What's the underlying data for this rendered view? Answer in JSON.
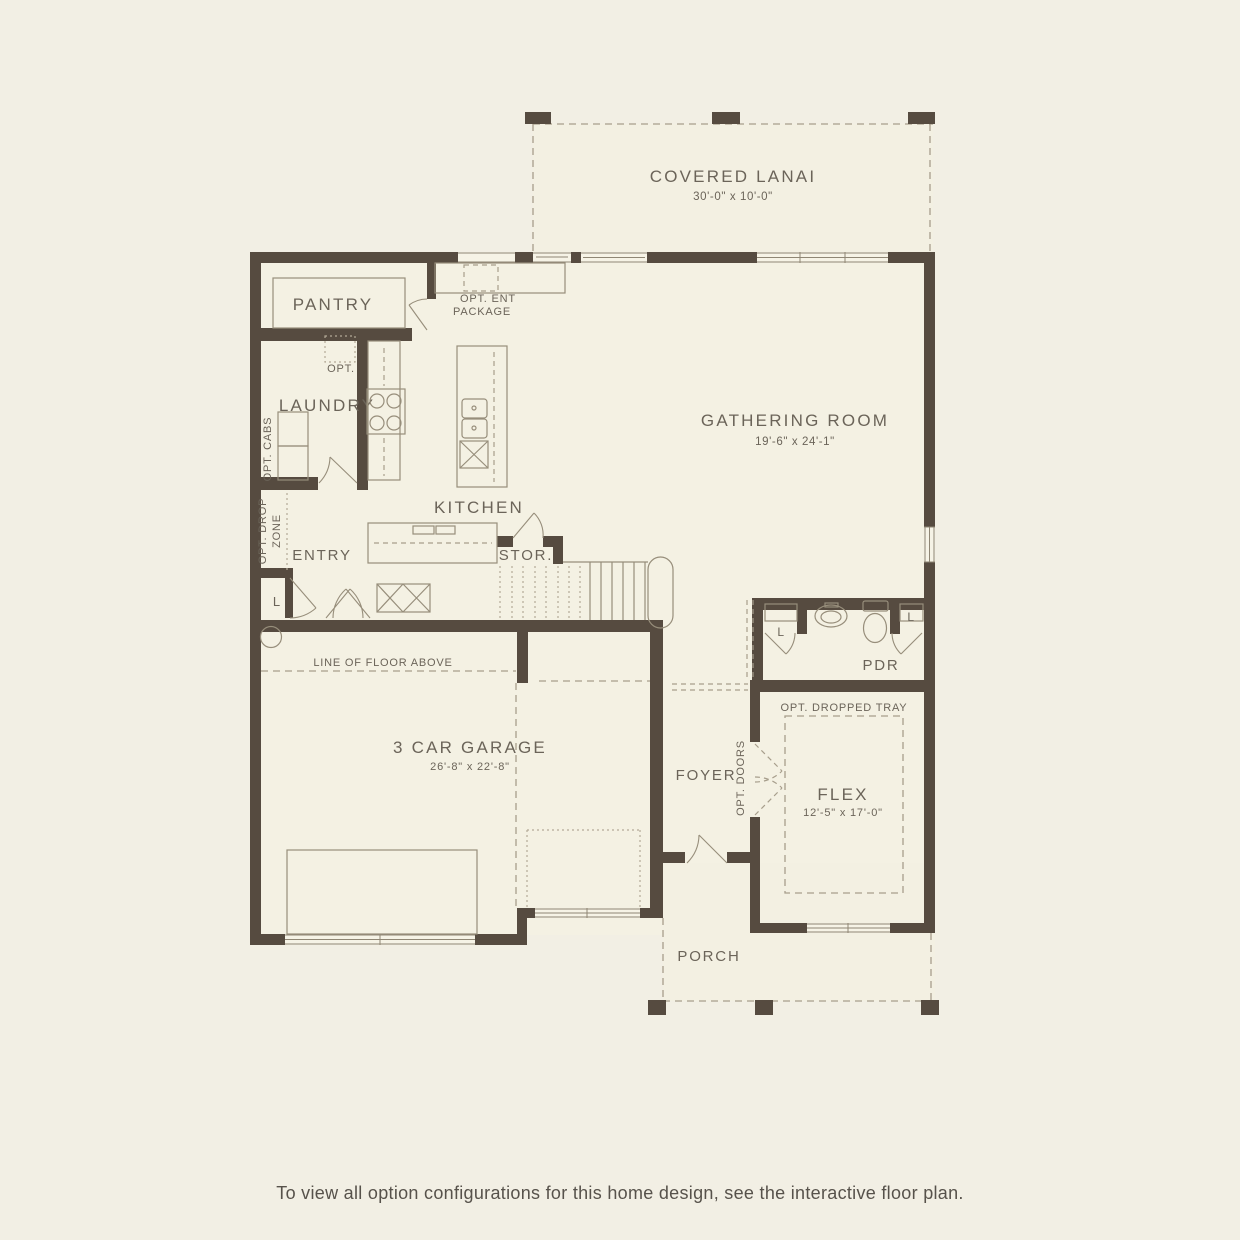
{
  "palette": {
    "background": "#f2efe4",
    "wall": "#564b40",
    "thin_line": "#978e7b",
    "dashed_line": "#a79e8c",
    "text": "#6b6459",
    "interior": "#f4f1e3"
  },
  "labels": {
    "lanai": "COVERED LANAI",
    "lanai_dims": "30'-0\" x 10'-0\"",
    "pantry": "PANTRY",
    "opt_ent_1": "OPT. ENT",
    "opt_ent_2": "PACKAGE",
    "opt": "OPT.",
    "opt_cabs": "OPT. CABS",
    "laundry": "LAUNDRY",
    "kitchen": "KITCHEN",
    "gathering": "GATHERING ROOM",
    "gathering_dims": "19'-6\" x 24'-1\"",
    "opt_drop_1": "OPT. DROP",
    "opt_drop_2": "ZONE",
    "entry": "ENTRY",
    "stor": "STOR.",
    "closet": "L",
    "line_of_floor_above": "LINE OF FLOOR ABOVE",
    "garage": "3 CAR GARAGE",
    "garage_dims": "26'-8\" x 22'-8\"",
    "foyer": "FOYER",
    "opt_doors": "OPT. DOORS",
    "pdr": "PDR",
    "opt_dropped_tray": "OPT. DROPPED TRAY",
    "flex": "FLEX",
    "flex_dims": "12'-5\" x 17'-0\"",
    "porch": "PORCH",
    "footer": "To view all option configurations for this home design, see the interactive floor plan."
  }
}
